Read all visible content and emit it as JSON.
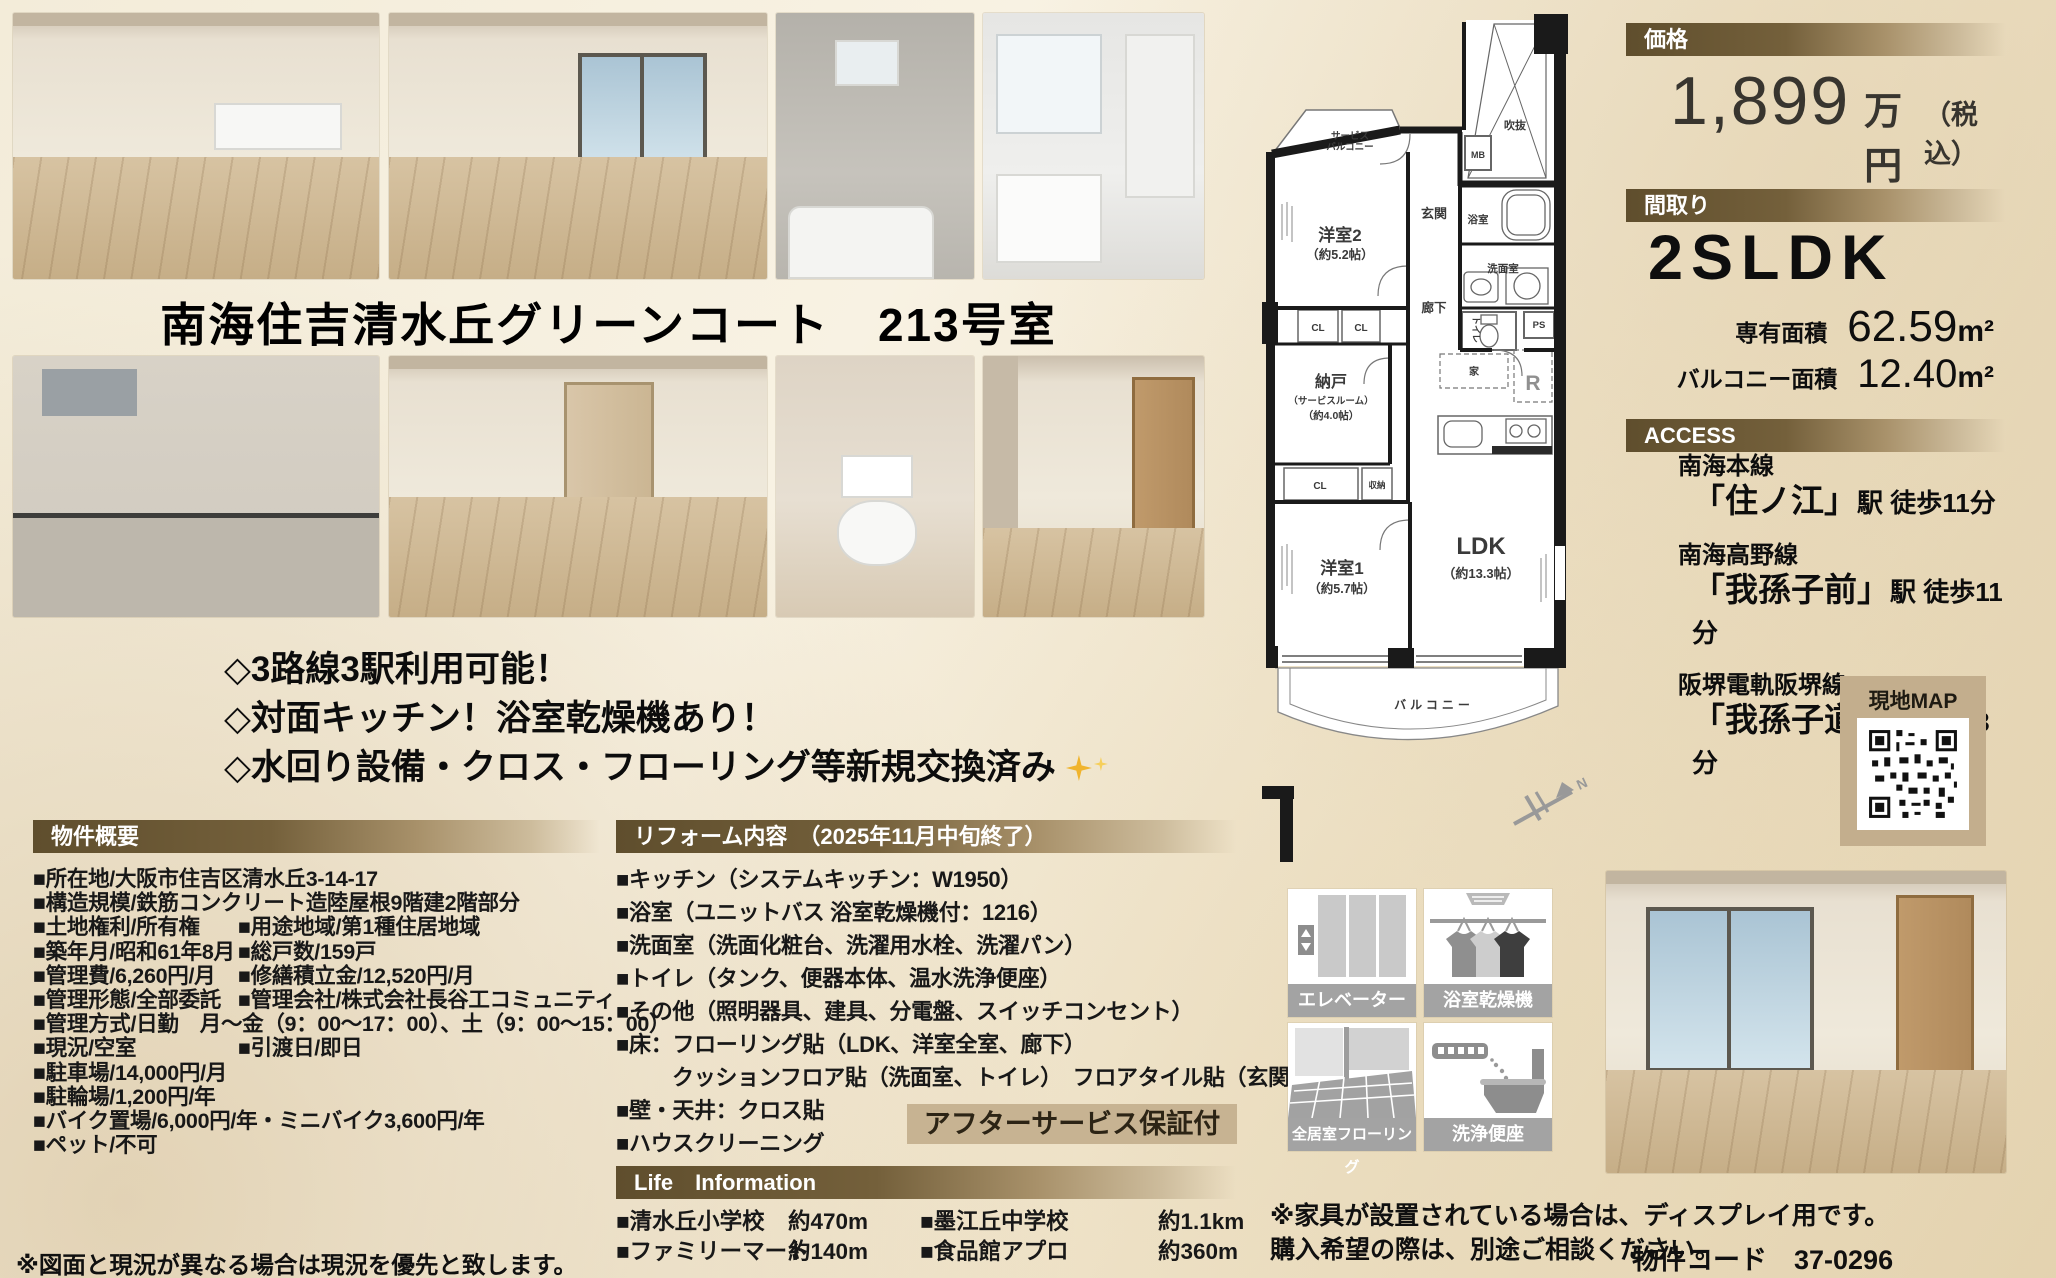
{
  "title": "南海住吉清水丘グリーンコート　213号室",
  "highlights": {
    "line1": "◇3路線3駅利用可能！",
    "line2": "◇対面キッチン！浴室乾燥機あり！",
    "line3": "◇水回り設備・クロス・フローリング等新規交換済み"
  },
  "overview": {
    "header": "物件概要",
    "rows": [
      {
        "c1": "■所在地/大阪市住吉区清水丘3-14-17",
        "c2": ""
      },
      {
        "c1": "■構造規模/鉄筋コンクリート造陸屋根9階建2階部分",
        "c2": ""
      },
      {
        "c1": "■土地権利/所有権",
        "c2": "■用途地域/第1種住居地域"
      },
      {
        "c1": "■築年月/昭和61年8月",
        "c2": "■総戸数/159戸"
      },
      {
        "c1": "■管理費/6,260円/月",
        "c2": "■修繕積立金/12,520円/月"
      },
      {
        "c1": "■管理形態/全部委託",
        "c2": "■管理会社/株式会社長谷工コミュニティ"
      },
      {
        "c1": "■管理方式/日勤　月～金（9：00～17：00）、土（9：00～15：00）",
        "c2": ""
      },
      {
        "c1": "■現況/空室",
        "c2": "■引渡日/即日"
      },
      {
        "c1": "■駐車場/14,000円/月",
        "c2": ""
      },
      {
        "c1": "■駐輪場/1,200円/年",
        "c2": ""
      },
      {
        "c1": "■バイク置場/6,000円/年・ミニバイク3,600円/年",
        "c2": ""
      },
      {
        "c1": "■ペット/不可",
        "c2": ""
      }
    ]
  },
  "reform": {
    "header": "リフォーム内容　（2025年11月中旬終了）",
    "items": [
      "■キッチン（システムキッチン：W1950）",
      "■浴室（ユニットバス 浴室乾燥機付：1216）",
      "■洗面室（洗面化粧台、洗濯用水栓、洗濯パン）",
      "■トイレ（タンク、便器本体、温水洗浄便座）",
      "■その他（照明器具、建具、分電盤、スイッチコンセント）",
      "■床：フローリング貼（LDK、洋室全室、廊下）",
      "クッションフロア貼（洗面室、トイレ）　フロアタイル貼（玄関土間）",
      "■壁・天井：クロス貼",
      "■ハウスクリーニング"
    ],
    "badge": "アフターサービス保証付"
  },
  "life": {
    "header": "Life　Information",
    "items": [
      {
        "name": "■清水丘小学校",
        "distance": "約470m"
      },
      {
        "name": "■墨江丘中学校",
        "distance": "約1.1km"
      },
      {
        "name": "■ファミリーマート",
        "distance": "約140m"
      },
      {
        "name": "■食品館アプロ",
        "distance": "約360m"
      }
    ]
  },
  "price": {
    "header": "価格",
    "amount": "1,899",
    "unit": "万円",
    "tax_note": "（税込）"
  },
  "madori": {
    "header": "間取り",
    "type": "2SLDK",
    "area_label": "専有面積",
    "area_value": "62.59",
    "balcony_label": "バルコニー面積",
    "balcony_value": "12.40",
    "sqm": "m²"
  },
  "access": {
    "header": "ACCESS",
    "routes": [
      {
        "line": "南海本線",
        "station": "「住ノ江」",
        "walk": "駅 徒歩11分"
      },
      {
        "line": "南海高野線",
        "station": "「我孫子前」",
        "walk": "駅 徒歩11分"
      },
      {
        "line": "阪堺電軌阪堺線",
        "station": "「我孫子道」",
        "walk": "駅 徒歩3分"
      }
    ]
  },
  "map": {
    "label": "現地MAP"
  },
  "features": {
    "elevator": "エレベーター",
    "dryer": "浴室乾燥機",
    "flooring": "全居室フローリング",
    "washlet": "洗浄便座"
  },
  "floorplan": {
    "service_balcony1": "サービス",
    "service_balcony2": "バルコニー",
    "room2": "洋室2",
    "room2_size": "（約5.2帖）",
    "genkan": "玄関",
    "mb": "MB",
    "fukinuke": "吹抜",
    "bath": "浴室",
    "washroom": "洗面室",
    "hall": "廊下",
    "cl1": "CL",
    "cl2": "CL",
    "nando": "納戸",
    "nando_sub": "（サービスルーム）",
    "nando_size": "（約4.0帖）",
    "toilet": "トイレ",
    "ps": "PS",
    "furniture": "家",
    "fridge": "R",
    "cl3": "CL",
    "shuno": "収納",
    "room1": "洋室1",
    "room1_size": "（約5.7帖）",
    "ldk": "LDK",
    "ldk_size": "（約13.3帖）",
    "balcony": "バルコニー",
    "north": "N"
  },
  "notes": {
    "furniture1": "※家具が設置されている場合は、ディスプレイ用です。",
    "furniture2": "購入希望の際は、別途ご相談ください。",
    "plan": "※図面と現況が異なる場合は現況を優先と致します。",
    "property_code": "物件コード　37-0296"
  },
  "colors": {
    "header_brown": "#5f4e2d",
    "badge_tan": "#c7b392",
    "accent_gold": "#f0b42d"
  }
}
